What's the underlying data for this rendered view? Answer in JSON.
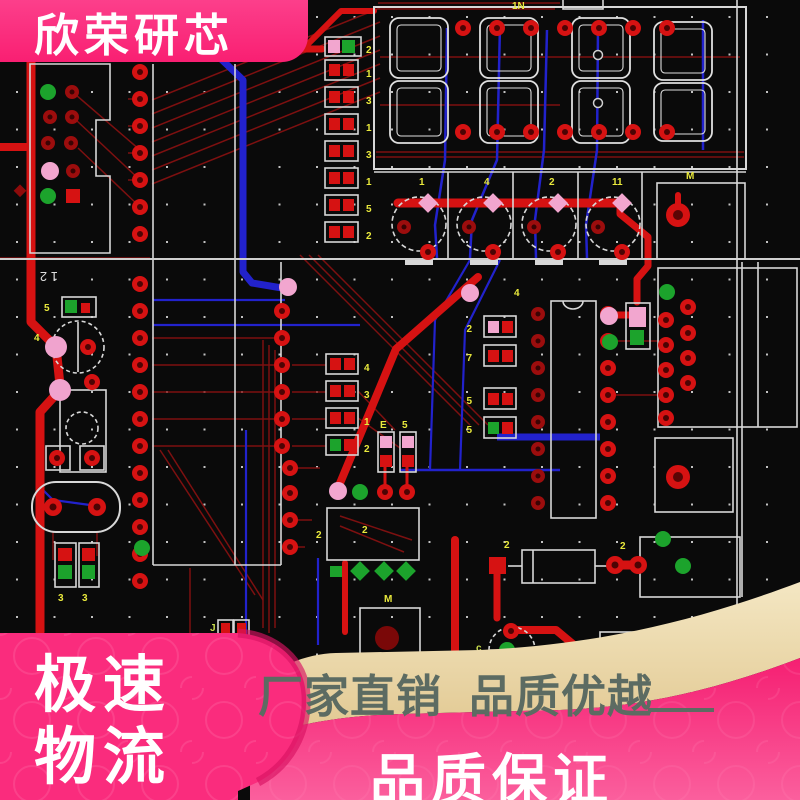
{
  "image_type": "pcb-layout-product-image",
  "top_banner": {
    "brand": "欣荣研芯",
    "bg": "#fa2c7d",
    "text_color": "#ffffff"
  },
  "bottom_banner": {
    "shipping_line1": "极速",
    "shipping_line2": "物流",
    "slogan": "厂家直销  品质优越",
    "guarantee": "品质保证",
    "pink": "#fa2c7d",
    "fold_pink": "#d81262",
    "cream": "#ebd6a4",
    "slogan_color": "#5c6b62",
    "text_color": "#ffffff"
  },
  "pcb": {
    "background": "#0a0a0a",
    "grid_dot_color": "#c3c3c3",
    "silkscreen_color": "#d8d8d8",
    "copper_bright": "#d61212",
    "copper_dark": "#7d1010",
    "signal_blue": "#2222cc",
    "pad_green": "#1ca32c",
    "pad_pink": "#f2a6cf",
    "label_color": "#e9e93c",
    "silkscreen_text": "1 2",
    "top_label": "1N",
    "transistor_refs": [
      "1",
      "4",
      "2",
      "11"
    ],
    "resistor_labels_right": [
      "2",
      "1",
      "3",
      "1",
      "3",
      "1",
      "5",
      "2"
    ],
    "resistor_labels_mid": [
      "4",
      "3",
      "1",
      "2"
    ],
    "smd_labels_center": [
      "2",
      "7",
      "5",
      "5"
    ],
    "misc_labels": {
      "m1": "M",
      "bow": "M",
      "b1": "4",
      "box2a": "2",
      "box2b": "2",
      "d1": "2",
      "d2": "2",
      "e1": "E",
      "e2": "5",
      "j1": "J",
      "c1": "c",
      "z1": "3",
      "z2": "3",
      "y1": "5",
      "y2": "4"
    }
  }
}
